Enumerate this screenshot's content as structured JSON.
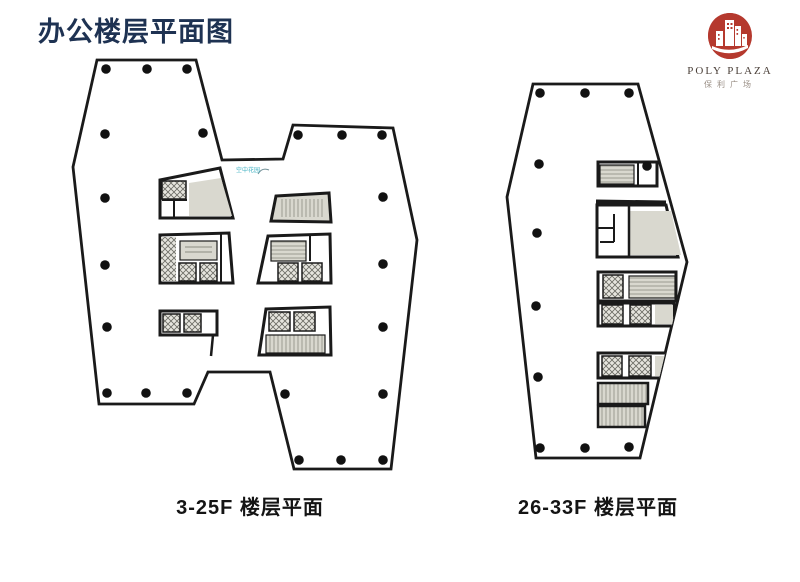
{
  "page": {
    "title": "办公楼层平面图"
  },
  "logo": {
    "brand": "POLY PLAZA",
    "brand_cn": "保利广场",
    "icon": "red-seal-building-skyline",
    "seal_color": "#b5392e"
  },
  "plans": [
    {
      "id": "plan-3-25f",
      "caption": "3-25F 楼层平面",
      "annotation": "空中花园"
    },
    {
      "id": "plan-26-33f",
      "caption": "26-33F 楼层平面"
    }
  ],
  "colors": {
    "title_text": "#1e3252",
    "caption_text": "#141414",
    "wall_line": "#1a1a1a",
    "room_gray": "#d9d8cf",
    "hatch_bg": "#e6e5de",
    "annotation_teal": "#45b3c4"
  }
}
